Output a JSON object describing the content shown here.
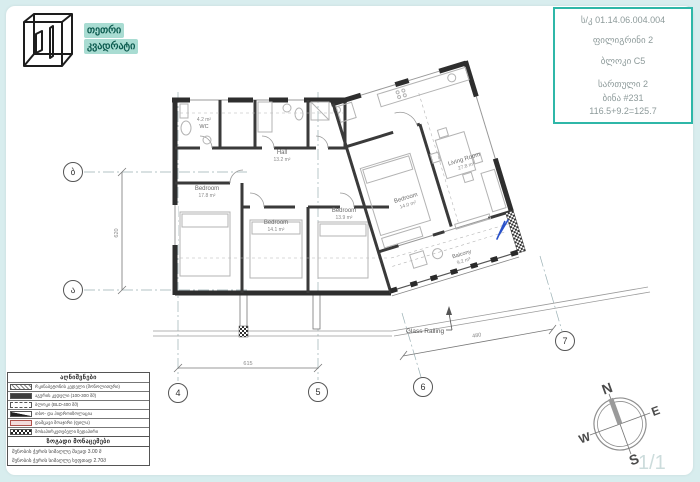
{
  "logo": {
    "line1": "თეთრი",
    "line2": "კვადრატი"
  },
  "info_box": {
    "accent_color": "#2fb7a8",
    "line1": "ს/კ 01.14.06.004.004",
    "line2": "ფილიგრინი 2",
    "line3": "ბლოკი C5",
    "line4": "სართული 2",
    "line5": "ბინა #231",
    "line6": "116.5+9.2=125.7"
  },
  "plan": {
    "rooms": {
      "wc": {
        "name": "WC",
        "area": "4.2 m²"
      },
      "hall": {
        "name": "Hall",
        "area": "13.2 m²"
      },
      "bedroom1": {
        "name": "Bedroom",
        "area": "17.8 m²"
      },
      "bedroom2": {
        "name": "Bedroom",
        "area": "14.1 m²"
      },
      "bedroom3": {
        "name": "Bedroom",
        "area": "13.9 m²"
      },
      "bedroom4": {
        "name": "Bedroom",
        "area": "14.0 m²"
      },
      "living": {
        "name": "Living Room",
        "area": "27.8 m²"
      },
      "balcony": {
        "name": "Balcony",
        "area": "9.2 m²"
      }
    },
    "glass_railing_label": "Glass Railing",
    "grid": {
      "c4": "4",
      "c5": "5",
      "c6": "6",
      "c7": "7",
      "rb": "ბ",
      "ra": "ა"
    },
    "dims": {
      "d45": "615",
      "d67": "480",
      "dab": "620"
    }
  },
  "legend": {
    "title": "აღნიშვნები",
    "rows": [
      {
        "label": "რკინაბეტონის კედელი (მონოლითური)"
      },
      {
        "label": "აგურის კედელი (100-300 მმ)"
      },
      {
        "label": "ბლოკი (BLD-400 მმ)"
      },
      {
        "label": "თბო- და ჰიდროიზოლაცია"
      },
      {
        "label": "დამცავი მოაჯირი (ფილა)"
      },
      {
        "label": "მოსაპირკეთებელი ზედაპირი"
      }
    ]
  },
  "notes": {
    "title": "ზოგადი მონაცემები",
    "lines": [
      "შენობის ჭერის სიმაღლე შავად 3.00 მ",
      "შენობის ჭერის სიმაღლე სუფთად 2.70მ"
    ]
  },
  "compass": {
    "n": "N",
    "e": "E",
    "s": "S",
    "w": "W"
  },
  "page_number": "1/1"
}
